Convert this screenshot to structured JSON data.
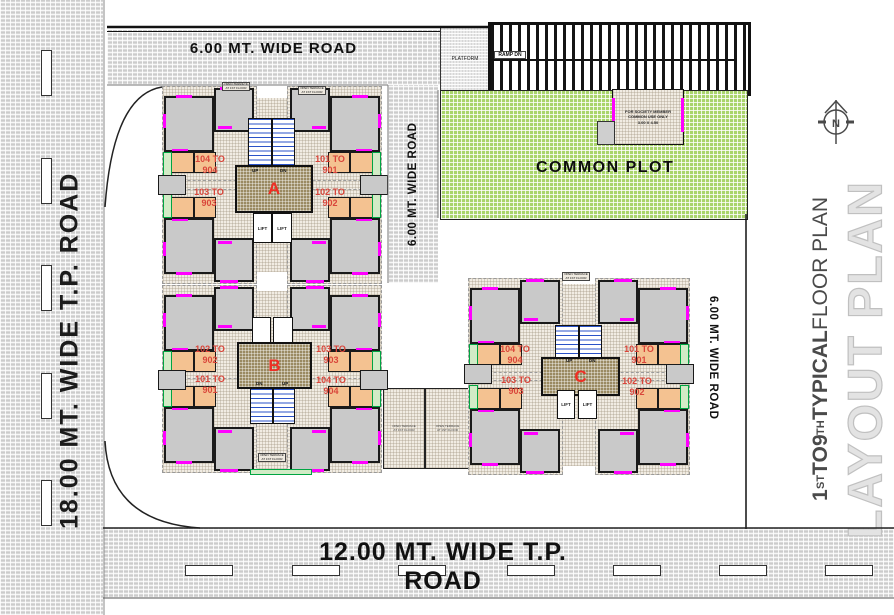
{
  "roads": {
    "left": "18.00 MT. WIDE T.P. ROAD",
    "top": "6.00 MT. WIDE ROAD",
    "middle": "6.00 MT. WIDE ROAD",
    "right": "6.00 MT. WIDE ROAD",
    "bottom": "12.00 MT. WIDE T.P. ROAD"
  },
  "areas": {
    "common_plot": "COMMON PLOT",
    "platform": "PLATFORM",
    "ramp": "RAMP DN",
    "society_box": {
      "line1": "FOR SOCIETY MEMBER",
      "line2": "COMMON USE ONLY",
      "line3": "3.00 X 4.50"
    },
    "terrace_note": "OPEN TERRACE AT 1ST FLOOR"
  },
  "labels": {
    "lift": "LIFT",
    "up": "UP",
    "dn": "DN",
    "north": "N"
  },
  "buildings": {
    "a": {
      "name": "A",
      "units": {
        "top_left": "104 TO 904",
        "top_right": "101 TO 901",
        "bottom_left": "103 TO 903",
        "bottom_right": "102 TO 902"
      }
    },
    "b": {
      "name": "B",
      "units": {
        "top_left": "102 TO 902",
        "top_right": "103 TO 903",
        "bottom_left": "101 TO 901",
        "bottom_right": "104 TO 904"
      }
    },
    "c": {
      "name": "C",
      "units": {
        "top_left": "104 TO 904",
        "top_right": "101 TO 901",
        "bottom_left": "103 TO 903",
        "bottom_right": "102 TO 902"
      }
    }
  },
  "title": {
    "fp": {
      "n1": "1",
      "s1": "ST",
      "to": " TO ",
      "n2": "9",
      "s2": "TH",
      "typ": " TYPICAL ",
      "rest": "FLOOR PLAN"
    },
    "layout": "LAYOUT PLAN"
  },
  "colors": {
    "plot_green": "#a9d46b",
    "road_gray": "#d9d9d9",
    "core_brown": "#9a8a62",
    "stair_blue": "#2a52c8",
    "unit_red": "#d9453a",
    "magenta": "#ff00ff"
  }
}
